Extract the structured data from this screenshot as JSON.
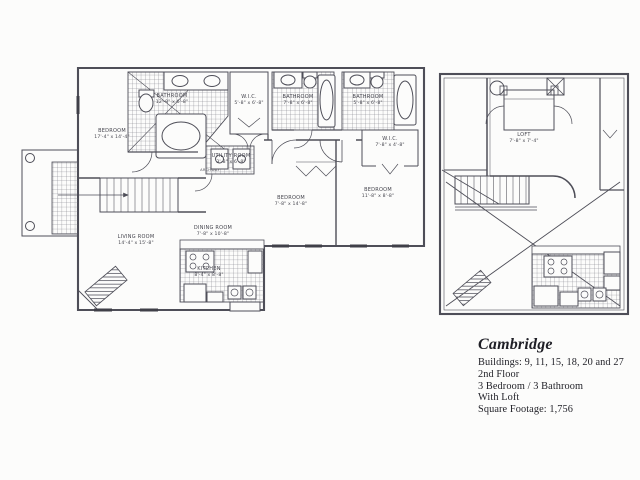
{
  "info": {
    "title": "Cambridge",
    "lines": [
      "Buildings: 9, 11, 15, 18, 20 and 27",
      "2nd Floor",
      "3 Bedroom / 3 Bathroom",
      "With Loft",
      "Square Footage: 1,756"
    ]
  },
  "main_plan": {
    "labels": {
      "master_bedroom": {
        "name": "BEDROOM",
        "dims": "17'-4\" x 14'-4\""
      },
      "master_bath": {
        "name": "BATHROOM",
        "dims": "12'-8\" x 6'-8\""
      },
      "wic1": {
        "name": "W.I.C.",
        "dims": "5'-8\" x 6'-8\""
      },
      "bath2": {
        "name": "BATHROOM",
        "dims": "7'-8\" x 6'-8\""
      },
      "bath3": {
        "name": "BATHROOM",
        "dims": "5'-8\" x 6'-8\""
      },
      "wic2": {
        "name": "W.I.C.",
        "dims": "7'-8\" x 4'-8\""
      },
      "utility": {
        "name": "UTILITY ROOM",
        "dims": "3'-8\" x 6'-8\""
      },
      "archway": {
        "name": "ARCHWAY"
      },
      "bedroom2": {
        "name": "BEDROOM",
        "dims": "7'-8\" x 14'-8\""
      },
      "bedroom3": {
        "name": "BEDROOM",
        "dims": "11'-8\" x 8'-8\""
      },
      "living": {
        "name": "LIVING ROOM",
        "dims": "14'-4\" x 15'-8\""
      },
      "dining": {
        "name": "DINING ROOM",
        "dims": "7'-8\" x 10'-8\""
      },
      "kitchen": {
        "name": "KITCHEN",
        "dims": "8'-4\" x 8'-8\""
      }
    }
  },
  "loft_plan": {
    "labels": {
      "loft": {
        "name": "LOFT",
        "dims": "7'-8\" x 7'-4\""
      }
    }
  },
  "colors": {
    "line": "#4e4e58",
    "text": "#1f1f26",
    "paper": "#fcfcfb"
  }
}
